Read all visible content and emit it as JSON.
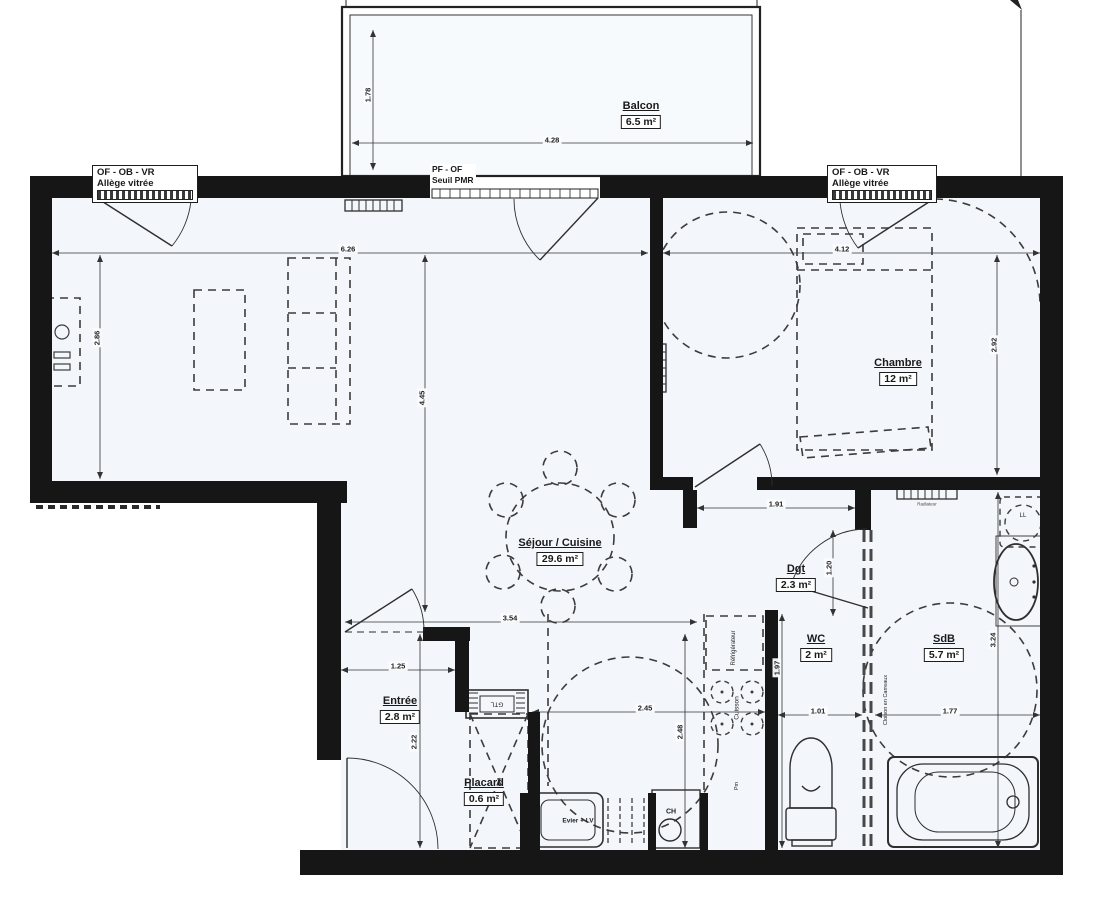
{
  "rooms": {
    "balcon": {
      "name": "Balcon",
      "area": "6.5 m²"
    },
    "sejour": {
      "name": "Séjour / Cuisine",
      "area": "29.6 m²"
    },
    "chambre": {
      "name": "Chambre",
      "area": "12 m²"
    },
    "dgt": {
      "name": "Dgt",
      "area": "2.3 m²"
    },
    "wc": {
      "name": "WC",
      "area": "2 m²"
    },
    "sdb": {
      "name": "SdB",
      "area": "5.7 m²"
    },
    "entree": {
      "name": "Entrée",
      "area": "2.8 m²"
    },
    "placard": {
      "name": "Placard",
      "area": "0.6 m²"
    }
  },
  "window_labels": {
    "left": {
      "line1": "OF - OB - VR",
      "line2": "Allège vitrée"
    },
    "right": {
      "line1": "OF - OB - VR",
      "line2": "Allège vitrée"
    },
    "balcony_door": {
      "line1": "PF - OF",
      "line2": "Seuil PMR"
    }
  },
  "equipment": {
    "refrigerator": "Réfrigérateur",
    "cooktop": "Cuisson",
    "sink": "Evier + LV",
    "water_heater": "CH",
    "gtl": "GTL",
    "washer": "LL",
    "radiator": "Radiateur",
    "pm": "Pm",
    "partition": "Cloison en Carreaux"
  },
  "dimensions": {
    "balcon_h": "1.78",
    "balcon_w": "4.28",
    "sejour_w": "6.26",
    "chambre_w": "4.12",
    "sejour_h": "2.86",
    "sejour_mid_h": "4.45",
    "chambre_h": "2.92",
    "dgt_w": "1.91",
    "dgt_h": "1.20",
    "sejour_s": "3.54",
    "entree_w": "1.25",
    "entree_h": "2.22",
    "cuisine_w": "2.45",
    "cuisine_h": "2.48",
    "wc_w": "1.01",
    "wc_h": "1.97",
    "sdb_w": "1.77",
    "sdb_h": "3.24"
  },
  "colors": {
    "wall": "#161616",
    "line": "#333333",
    "paper": "#ffffff",
    "room_fill": "#f3f7fb"
  }
}
